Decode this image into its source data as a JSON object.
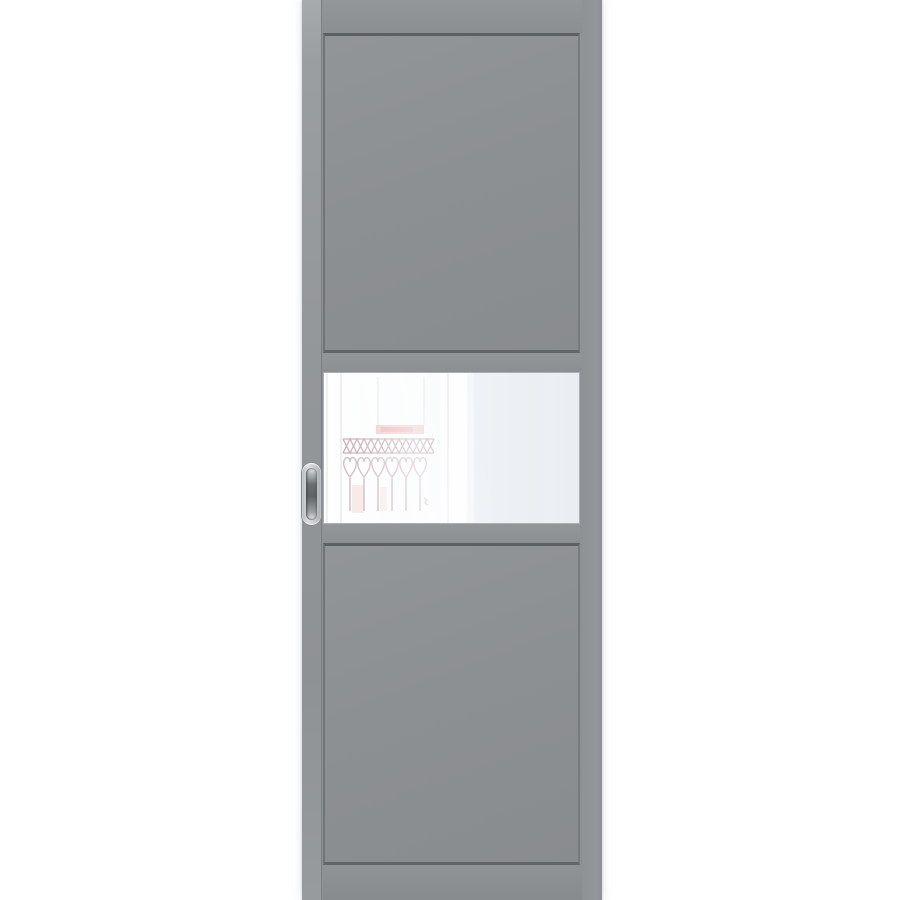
{
  "scene": {
    "type": "product-photo",
    "subject": "gray-sliding-interior-door-with-frosted-glass-insert",
    "background_color": "#ffffff"
  },
  "door": {
    "style": "three-section-flat-panel-sliding-door",
    "finish": "matte-gray",
    "colors": {
      "background": "#ffffff",
      "face": "#8f9295",
      "face-light": "#9b9ea1",
      "panel": "#8d9093",
      "panel-dark": "#898c8f",
      "recess-dark": "#5d6063",
      "recess-side": "#717477",
      "edge-strip": "#94979a",
      "edge-seam": "#7d8083",
      "glass-white": "#ffffff",
      "glass-tint": "#e9edf2",
      "glass-border": "#aab0b5",
      "reflect-band": "#e59a9a",
      "reflect-band-deep": "#de8888",
      "reflect-iron": "#96606c",
      "reflect-heart": "#a0707a",
      "reflect-post": "#9a7a82",
      "reflect-smudge": "#e9b6b6",
      "reflect-frame": "#d0d4d9",
      "handle-rim": "#dcdee0",
      "handle-body": "#b5b8bb",
      "handle-slot-dark": "#606366",
      "handle-slot-light": "#f3f4f5"
    }
  }
}
